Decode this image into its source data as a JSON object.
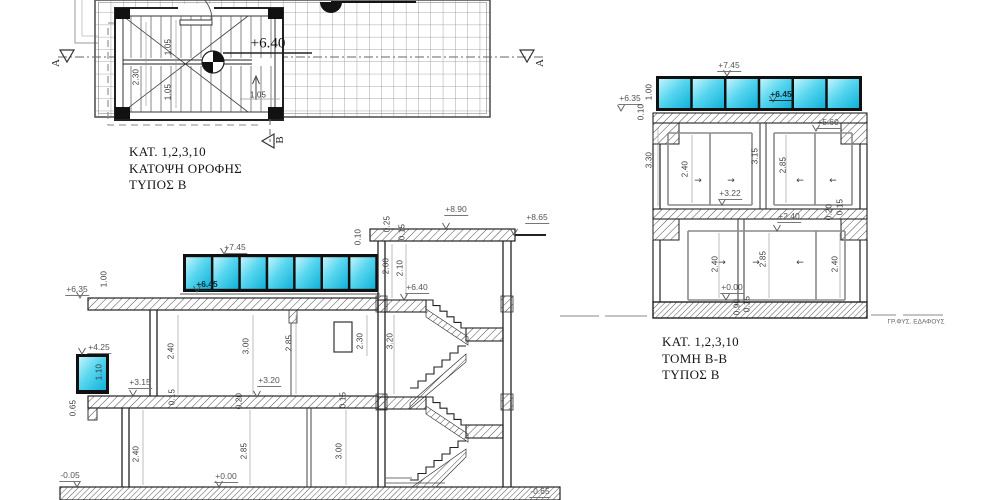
{
  "drawing": {
    "colors": {
      "window_cyan_light": "#c3f4fc",
      "window_cyan_mid": "#58d6ef",
      "window_cyan_deep": "#10b1d9",
      "ink": "#1a1a1a"
    },
    "plan": {
      "title_lines": [
        "ΚΑΤ.  1,2,3,10",
        "ΚΑΤΟΨΗ ΟΡΟΦΗΣ",
        "ΤΥΠΟΣ   Β"
      ],
      "labels": [
        {
          "name": "dim-stair-depth",
          "text": "2.30",
          "x": 136,
          "y": 77,
          "rot": true
        },
        {
          "name": "dim-flight-top",
          "text": "1.05",
          "x": 168,
          "y": 47,
          "rot": true
        },
        {
          "name": "dim-flight-bottom",
          "text": "1.05",
          "x": 168,
          "y": 92,
          "rot": true
        },
        {
          "name": "dim-landing",
          "text": "1.05",
          "x": 258,
          "y": 95
        },
        {
          "name": "elev-roof-level",
          "text": "+6.40",
          "x": 268,
          "y": 44,
          "kind": "elevbig"
        },
        {
          "name": "section-marker-a-left",
          "text": "A",
          "x": 56,
          "y": 63,
          "rot": true,
          "kind": "marker"
        },
        {
          "name": "section-marker-a-right",
          "text": "A",
          "x": 540,
          "y": 63,
          "rot": true,
          "kind": "marker"
        },
        {
          "name": "section-marker-b",
          "text": "B",
          "x": 280,
          "y": 140,
          "rot": true,
          "kind": "marker"
        }
      ]
    },
    "section_a": {
      "labels": [
        {
          "name": "elev-745",
          "text": "+7.45",
          "x": 235,
          "y": 248,
          "kind": "elev"
        },
        {
          "name": "elev-645",
          "text": "+6.45",
          "x": 207,
          "y": 285,
          "kind": "elevdark"
        },
        {
          "name": "elev-635",
          "text": "+6.35",
          "x": 77,
          "y": 290,
          "kind": "elev"
        },
        {
          "name": "elev-425",
          "text": "+4.25",
          "x": 99,
          "y": 348,
          "kind": "elev"
        },
        {
          "name": "elev-315",
          "text": "+3.15",
          "x": 140,
          "y": 383,
          "kind": "elev"
        },
        {
          "name": "elev-320",
          "text": "+3.20",
          "x": 269,
          "y": 381,
          "kind": "elev"
        },
        {
          "name": "elev-000",
          "text": "+0.00",
          "x": 226,
          "y": 477,
          "kind": "elev"
        },
        {
          "name": "elev-minus005",
          "text": "-0.05",
          "x": 70,
          "y": 476,
          "kind": "elev"
        },
        {
          "name": "elev-minus065",
          "text": "-0.65",
          "x": 540,
          "y": 492,
          "kind": "elev"
        },
        {
          "name": "elev-640",
          "text": "+6.40",
          "x": 417,
          "y": 288,
          "kind": "elev"
        },
        {
          "name": "elev-890",
          "text": "+8.90",
          "x": 456,
          "y": 210,
          "kind": "elev"
        },
        {
          "name": "elev-865",
          "text": "+8.65",
          "x": 537,
          "y": 218,
          "kind": "elev"
        },
        {
          "name": "dim-100",
          "text": "1.00",
          "x": 104,
          "y": 279,
          "rot": true
        },
        {
          "name": "dim-110",
          "text": "1.10",
          "x": 99,
          "y": 372,
          "rot": true
        },
        {
          "name": "dim-065",
          "text": "0.65",
          "x": 73,
          "y": 408,
          "rot": true
        },
        {
          "name": "dim-240-upper",
          "text": "2.40",
          "x": 171,
          "y": 351,
          "rot": true
        },
        {
          "name": "dim-300-upper",
          "text": "3.00",
          "x": 246,
          "y": 346,
          "rot": true
        },
        {
          "name": "dim-285-upper",
          "text": "2.85",
          "x": 289,
          "y": 343,
          "rot": true
        },
        {
          "name": "dim-230-upper",
          "text": "2.30",
          "x": 360,
          "y": 341,
          "rot": true
        },
        {
          "name": "dim-320-stair",
          "text": "3.20",
          "x": 390,
          "y": 341,
          "rot": true
        },
        {
          "name": "dim-015-upper",
          "text": "0.15",
          "x": 172,
          "y": 397,
          "rot": true
        },
        {
          "name": "dim-020-upper",
          "text": "0.20",
          "x": 239,
          "y": 401,
          "rot": true
        },
        {
          "name": "dim-015-upper-b",
          "text": "0.15",
          "x": 343,
          "y": 400,
          "rot": true
        },
        {
          "name": "dim-240-ground",
          "text": "2.40",
          "x": 136,
          "y": 454,
          "rot": true
        },
        {
          "name": "dim-285-ground",
          "text": "2.85",
          "x": 244,
          "y": 451,
          "rot": true
        },
        {
          "name": "dim-300-ground",
          "text": "3.00",
          "x": 339,
          "y": 451,
          "rot": true
        },
        {
          "name": "dim-010-parapet",
          "text": "0.10",
          "x": 358,
          "y": 237,
          "rot": true
        },
        {
          "name": "dim-025-slab",
          "text": "0.25",
          "x": 387,
          "y": 224,
          "rot": true
        },
        {
          "name": "dim-015-slab",
          "text": "0.15",
          "x": 402,
          "y": 232,
          "rot": true
        },
        {
          "name": "dim-200-stair",
          "text": "2.00",
          "x": 386,
          "y": 266,
          "rot": true
        },
        {
          "name": "dim-210-stair",
          "text": "2.10",
          "x": 400,
          "y": 268,
          "rot": true
        }
      ]
    },
    "section_b": {
      "title_lines": [
        "ΚΑΤ.  1,2,3,10",
        "ΤΟΜΗ Β-Β",
        "ΤΥΠΟΣ   Β"
      ],
      "ground_line_label": "ΓΡ.ΦΥΣ. ΕΔΑΦΟΥΣ",
      "labels": [
        {
          "name": "elev-745",
          "text": "+7.45",
          "x": 729,
          "y": 66,
          "kind": "elev"
        },
        {
          "name": "elev-645",
          "text": "+6.45",
          "x": 781,
          "y": 95,
          "kind": "elevdark"
        },
        {
          "name": "elev-635",
          "text": "+6.35",
          "x": 630,
          "y": 99,
          "kind": "elev"
        },
        {
          "name": "elev-560",
          "text": "+5.60",
          "x": 828,
          "y": 123,
          "kind": "elev"
        },
        {
          "name": "elev-322",
          "text": "+3.22",
          "x": 730,
          "y": 194,
          "kind": "elev"
        },
        {
          "name": "elev-240",
          "text": "+2.40",
          "x": 789,
          "y": 217,
          "kind": "elev"
        },
        {
          "name": "elev-000",
          "text": "+0.00",
          "x": 732,
          "y": 288,
          "kind": "elev"
        },
        {
          "name": "dim-100",
          "text": "1.00",
          "x": 649,
          "y": 92,
          "rot": true
        },
        {
          "name": "dim-010",
          "text": "0.10",
          "x": 641,
          "y": 112,
          "rot": true
        },
        {
          "name": "dim-330",
          "text": "3.30",
          "x": 649,
          "y": 160,
          "rot": true
        },
        {
          "name": "dim-240-upper",
          "text": "2.40",
          "x": 685,
          "y": 169,
          "rot": true
        },
        {
          "name": "dim-315",
          "text": "3.15",
          "x": 755,
          "y": 156,
          "rot": true
        },
        {
          "name": "dim-285-upper",
          "text": "2.85",
          "x": 783,
          "y": 165,
          "rot": true
        },
        {
          "name": "dim-020",
          "text": "0.20",
          "x": 829,
          "y": 212,
          "rot": true
        },
        {
          "name": "dim-015",
          "text": "0.15",
          "x": 840,
          "y": 207,
          "rot": true
        },
        {
          "name": "dim-240-ground-left",
          "text": "2.40",
          "x": 715,
          "y": 264,
          "rot": true
        },
        {
          "name": "dim-285-ground",
          "text": "2.85",
          "x": 763,
          "y": 259,
          "rot": true
        },
        {
          "name": "dim-240-ground-right",
          "text": "2.40",
          "x": 835,
          "y": 264,
          "rot": true
        },
        {
          "name": "dim-090",
          "text": "0.90",
          "x": 737,
          "y": 307,
          "rot": true
        },
        {
          "name": "dim-015-ground",
          "text": "0.15",
          "x": 747,
          "y": 304,
          "rot": true
        },
        {
          "name": "slide-arrow-ul-1",
          "text": "→",
          "x": 698,
          "y": 181,
          "kind": "arrow"
        },
        {
          "name": "slide-arrow-ul-2",
          "text": "→",
          "x": 731,
          "y": 181,
          "kind": "arrow"
        },
        {
          "name": "slide-arrow-ur-1",
          "text": "←",
          "x": 800,
          "y": 181,
          "kind": "arrow"
        },
        {
          "name": "slide-arrow-ur-2",
          "text": "←",
          "x": 833,
          "y": 181,
          "kind": "arrow"
        },
        {
          "name": "slide-arrow-g-1",
          "text": "→",
          "x": 722,
          "y": 263,
          "kind": "arrow"
        },
        {
          "name": "slide-arrow-g-2",
          "text": "→",
          "x": 756,
          "y": 263,
          "kind": "arrow"
        },
        {
          "name": "slide-arrow-g-3",
          "text": "←",
          "x": 800,
          "y": 263,
          "kind": "arrow"
        },
        {
          "name": "ground-line-label",
          "text": "ΓΡ.ΦΥΣ. ΕΔΑΦΟΥΣ",
          "x": 916,
          "y": 322,
          "kind": "tiny"
        }
      ]
    }
  }
}
